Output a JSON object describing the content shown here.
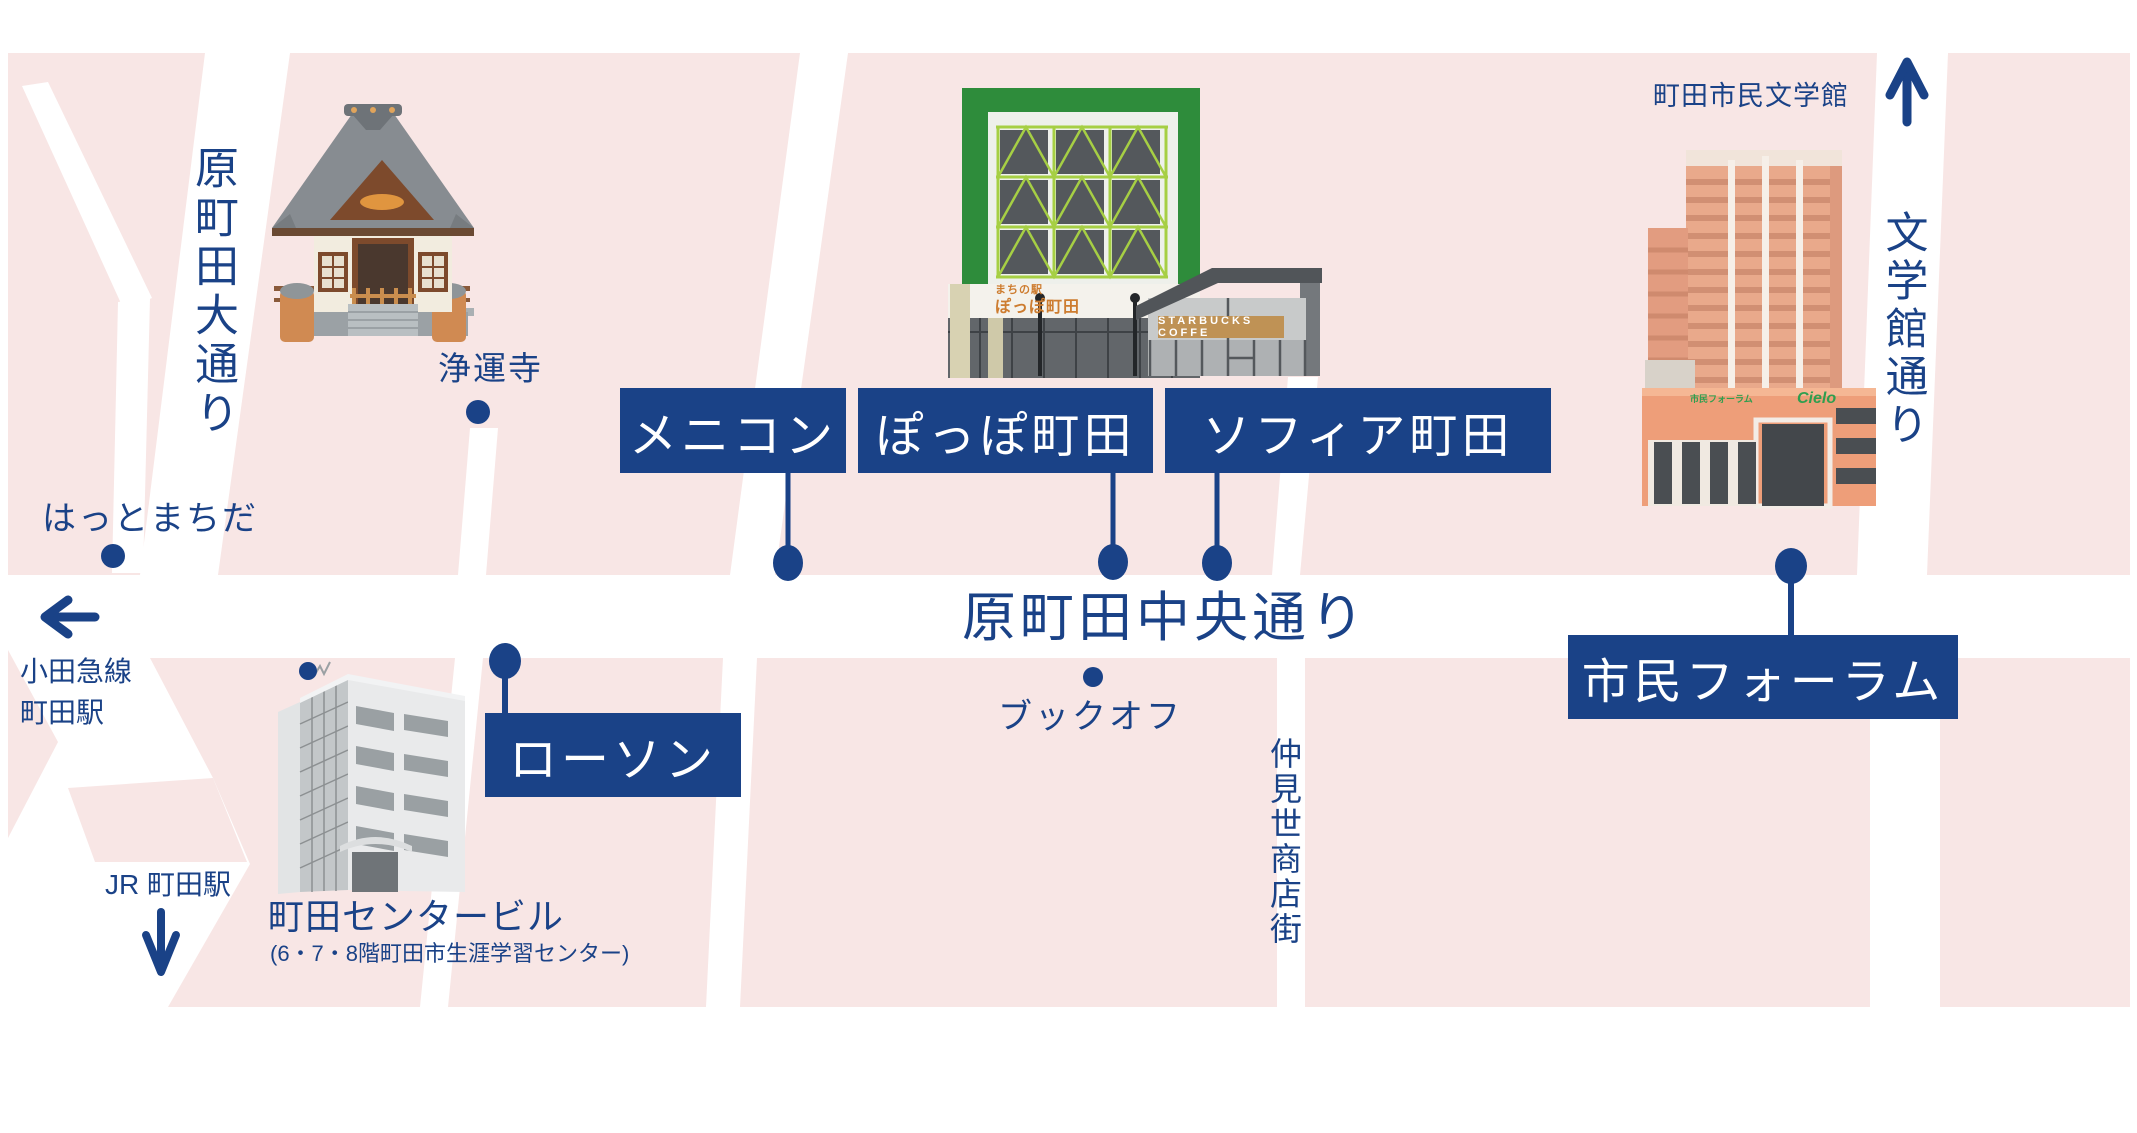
{
  "streets": {
    "haramachida_odori": "原町田大通り",
    "haramachida_chuo_dori": "原町田中央通り",
    "nakamise_shotengai": "仲見世商店街",
    "bungakukan_dori": "文学館通り"
  },
  "label_boxes": {
    "menicon": "メニコン",
    "poppo_machida": "ぽっぽ町田",
    "sophia_machida": "ソフィア町田",
    "lawson": "ローソン",
    "shimin_forum": "市民フォーラム"
  },
  "places": {
    "jounji": "浄運寺",
    "hatto_machida": "はっとまちだ",
    "bookoff": "ブックオフ",
    "machida_center_building": "町田センタービル",
    "machida_center_building_note": "(6・7・8階町田市生涯学習センター)",
    "machida_shimin_bungakukan": "町田市民文学館"
  },
  "stations": {
    "odakyu_line1": "小田急線",
    "odakyu_line2": "町田駅",
    "jr": "JR 町田駅"
  },
  "building_signs": {
    "poppo_station_line1": "まちの駅",
    "poppo_station_line2": "ぽっぽ町田",
    "starbucks": "STARBUCKS COFFE",
    "forum_logo_left": "市民フォーラム",
    "forum_logo_right": "Cielo"
  },
  "colors": {
    "navy": "#1a4287",
    "block_pink": "#f8e6e5",
    "street_white": "#ffffff",
    "green_dark": "#2e8c3b",
    "green_light": "#a6cf44",
    "sign_orange": "#cd7c2f",
    "starbucks_tan": "#bf9255",
    "salmon": "#e9a98b",
    "logo_green": "#2f9e4f"
  }
}
